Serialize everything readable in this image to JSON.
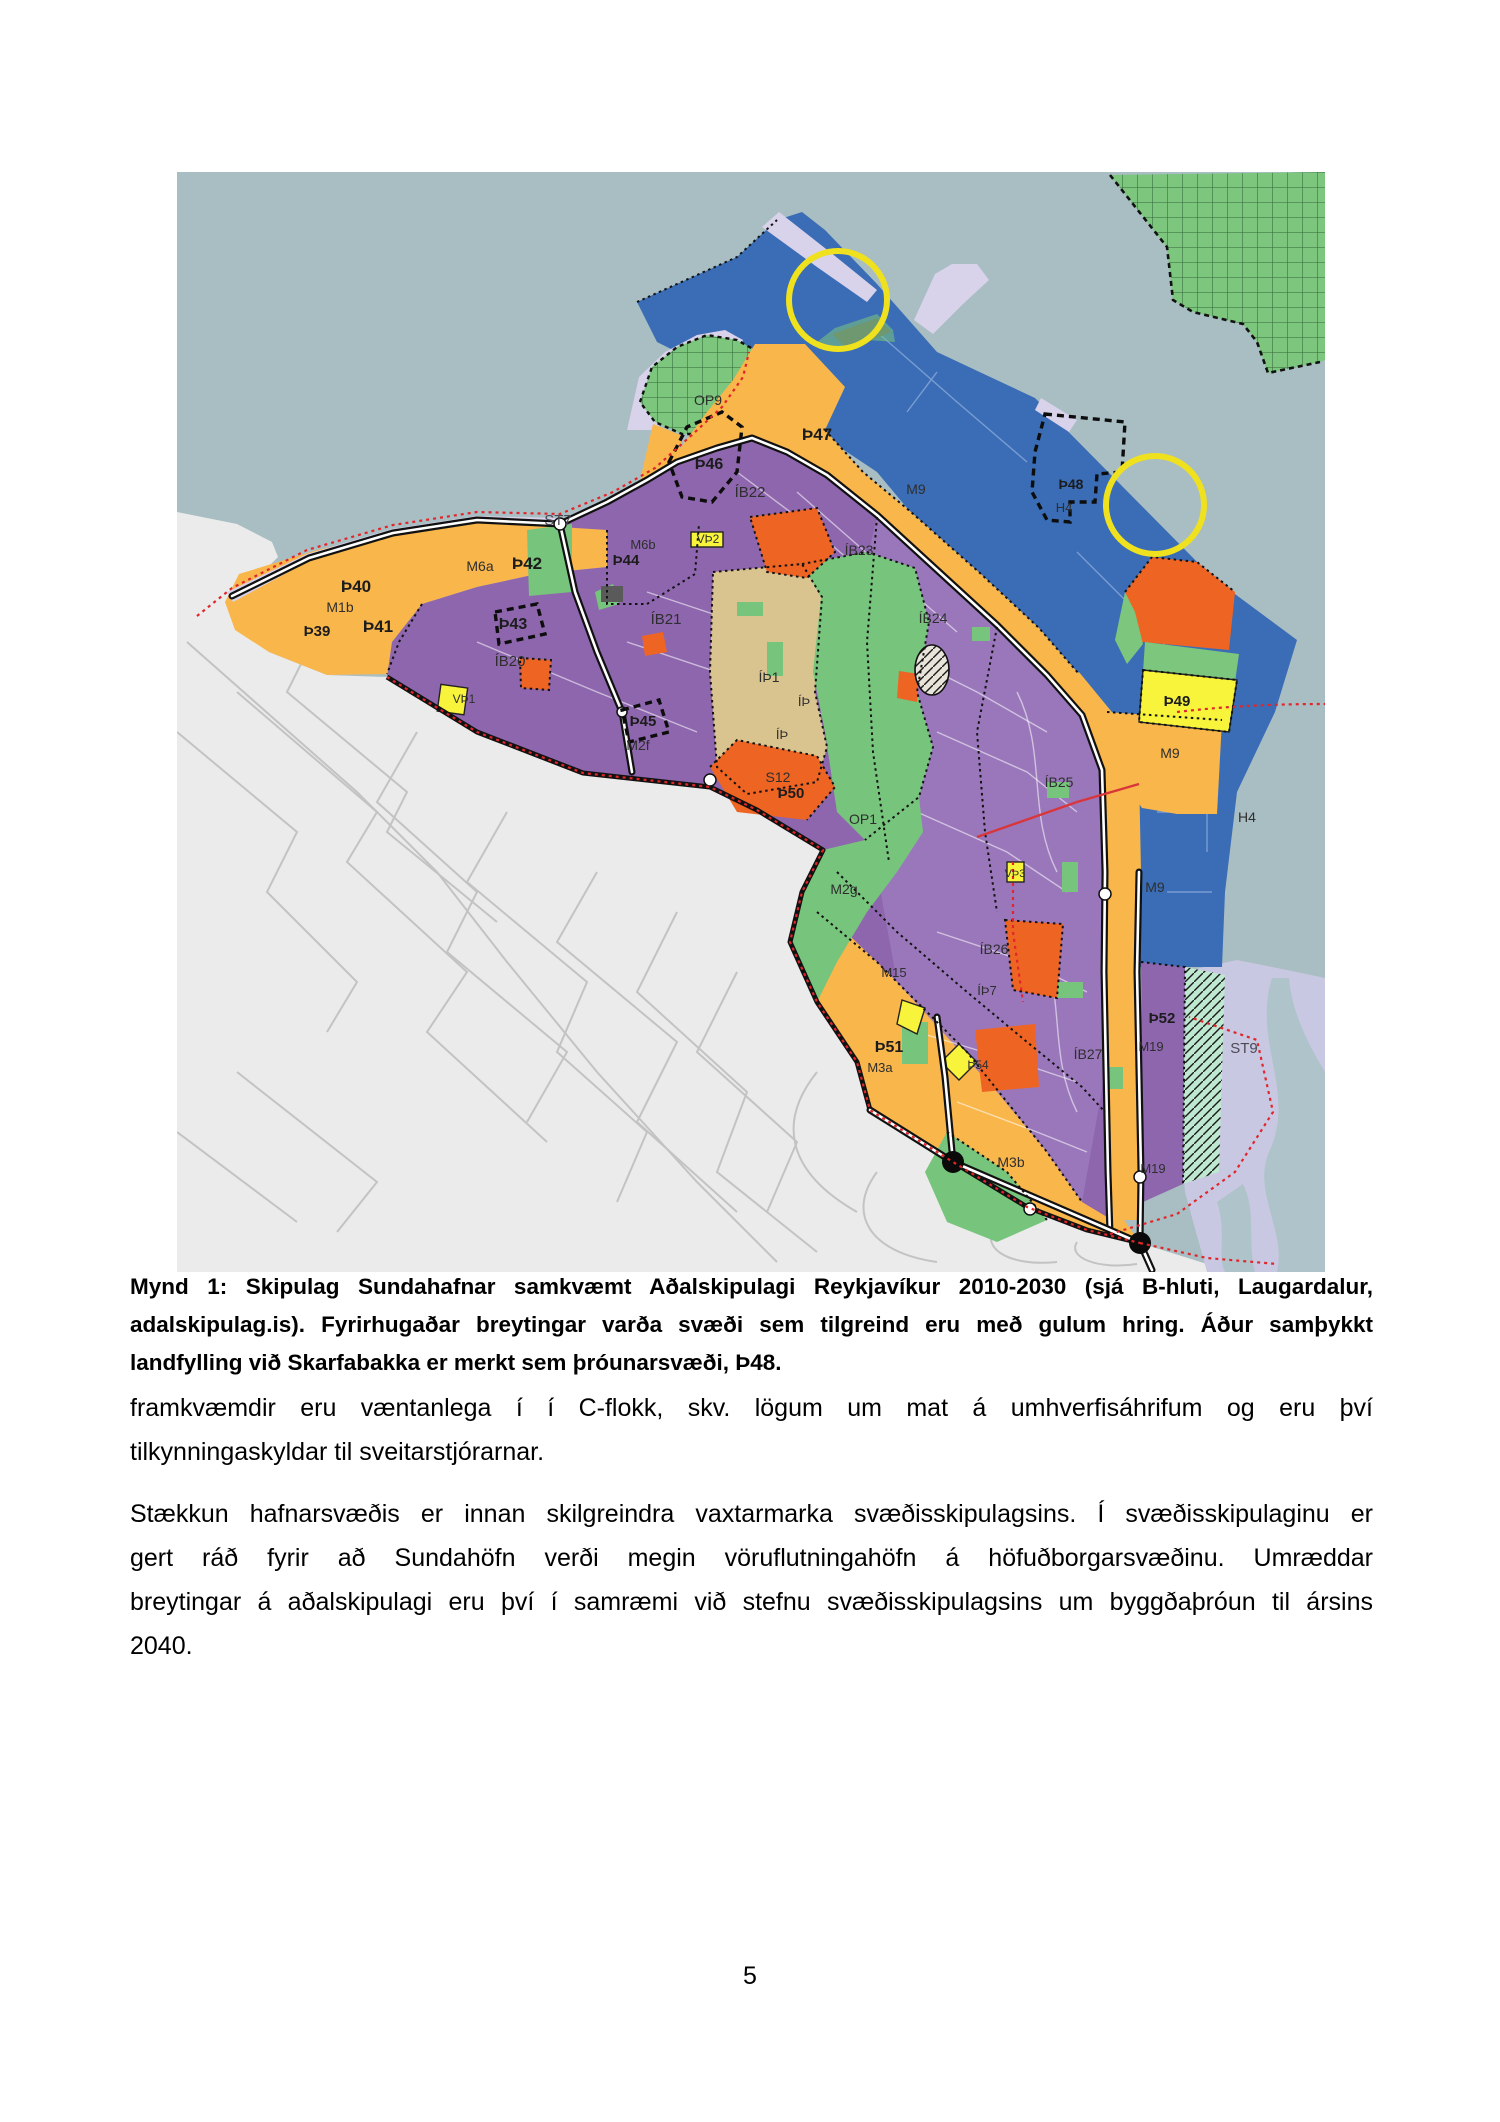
{
  "page": {
    "number": "5"
  },
  "figure": {
    "caption_lines": [
      "Mynd 1: Skipulag Sundahafnar samkvæmt Aðalskipulagi Reykjavíkur 2010-2030 (sjá B-hluti, Laugardalur,",
      "adalskipulag.is). Fyrirhugaðar breytingar varða svæði sem tilgreind eru með gulum hring. Áður samþykkt",
      "landfylling við Skarfabakka er merkt sem þróunarsvæði, Þ48."
    ],
    "map": {
      "colors": {
        "sea": "#a9bec3",
        "city": "#ebebeb",
        "harbor_blue": "#3a6db5",
        "amber": "#f9b64b",
        "purple": "#8e66ae",
        "green": "#77c47c",
        "tan": "#d9c38e",
        "red_orange": "#ee6423",
        "yellow_zone": "#f7f43b",
        "lavender": "#d8d2eb",
        "estuary": "#c9c8e2",
        "mint": "#bfe8d0",
        "highlight_circle": "#f0e11e",
        "red_boundary": "#e0262b"
      },
      "labels": [
        {
          "text": "ST7"
        },
        {
          "text": "Þ40"
        },
        {
          "text": "M1b"
        },
        {
          "text": "Þ39"
        },
        {
          "text": "Þ41"
        },
        {
          "text": "M6a"
        },
        {
          "text": "Þ42"
        },
        {
          "text": "Þ43"
        },
        {
          "text": "ÍB20"
        },
        {
          "text": "VÞ1"
        },
        {
          "text": "M6b"
        },
        {
          "text": "Þ44"
        },
        {
          "text": "OP9"
        },
        {
          "text": "Þ46"
        },
        {
          "text": "Þ47"
        },
        {
          "text": "ÍB22"
        },
        {
          "text": "VÞ2"
        },
        {
          "text": "M9"
        },
        {
          "text": "ÍB23"
        },
        {
          "text": "Þ48"
        },
        {
          "text": "H4"
        },
        {
          "text": "ÍB21"
        },
        {
          "text": "ÍÞ1"
        },
        {
          "text": "ÍÞ"
        },
        {
          "text": "ÍÞ"
        },
        {
          "text": "Þ45"
        },
        {
          "text": "M2f"
        },
        {
          "text": "S12"
        },
        {
          "text": "Þ50"
        },
        {
          "text": "OP1"
        },
        {
          "text": "ÍB24"
        },
        {
          "text": "Þ49"
        },
        {
          "text": "M9"
        },
        {
          "text": "H4"
        },
        {
          "text": "ÍB25"
        },
        {
          "text": "M9"
        },
        {
          "text": "VÞ3"
        },
        {
          "text": "M2g"
        },
        {
          "text": "ÍB26"
        },
        {
          "text": "ÍÞ7"
        },
        {
          "text": "M15"
        },
        {
          "text": "Þ51"
        },
        {
          "text": "M3a"
        },
        {
          "text": "Þ54"
        },
        {
          "text": "ÍB27"
        },
        {
          "text": "Þ52"
        },
        {
          "text": "M19"
        },
        {
          "text": "ST9"
        },
        {
          "text": "M3b"
        },
        {
          "text": "M19"
        }
      ]
    }
  },
  "paragraphs": [
    {
      "lines": [
        "framkvæmdir eru væntanlega í í C-flokk, skv. lögum um mat á umhverfisáhrifum og eru því",
        "tilkynningaskyldar til sveitarstjórarnar."
      ]
    },
    {
      "lines": [
        "Stækkun hafnarsvæðis er innan skilgreindra vaxtarmarka svæðisskipulagsins. Í svæðisskipulaginu er",
        "gert ráð fyrir að Sundahöfn verði megin vöruflutningahöfn á höfuðborgarsvæðinu. Umræddar",
        "breytingar á aðalskipulagi eru því í samræmi við stefnu svæðisskipulagsins um byggðaþróun til ársins",
        "2040."
      ]
    }
  ]
}
